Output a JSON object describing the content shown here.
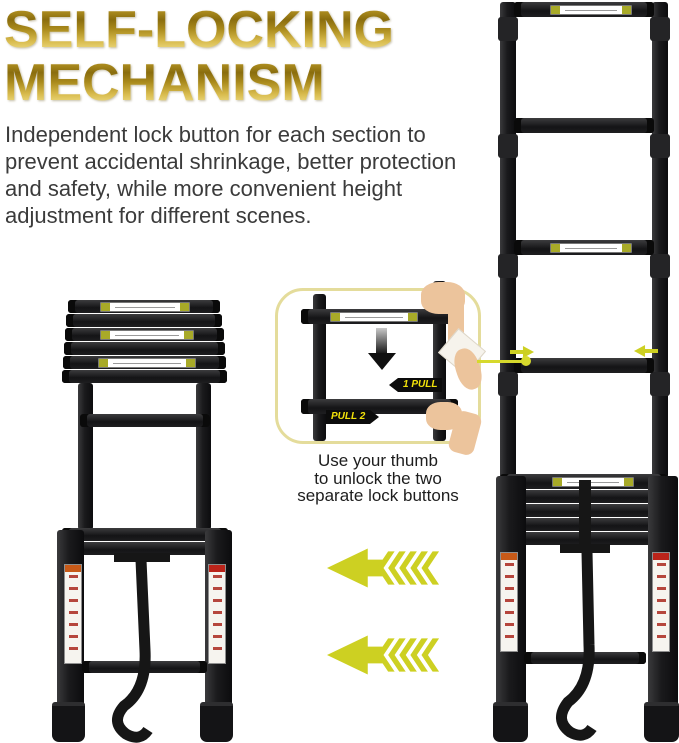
{
  "title": {
    "line1": "SELF-LOCKING",
    "line2": "MECHANISM"
  },
  "description": {
    "text": "Independent lock button for each section to prevent accidental shrinkage, better protection and safety, while more convenient height adjustment for different scenes."
  },
  "inset": {
    "pull_step_1": "1 PULL",
    "pull_step_2": "PULL 2",
    "caption_lines": [
      "Use your thumb",
      "to unlock the two",
      "separate lock buttons"
    ]
  },
  "colors": {
    "title_gold_dark": "#8a6d0e",
    "title_gold_light": "#f2e492",
    "body_text": "#3b3b3b",
    "arrow_yellow": "#cdd022",
    "inset_border": "#e4dc9b",
    "ladder_black": "#1b1b1d",
    "rung_label_end": "#a8aa28",
    "sticker_header_orange": "#c85a18",
    "sticker_header_red": "#bb241a",
    "pull_label_text": "#f2e20a",
    "skin_tone": "#ecc49c"
  }
}
